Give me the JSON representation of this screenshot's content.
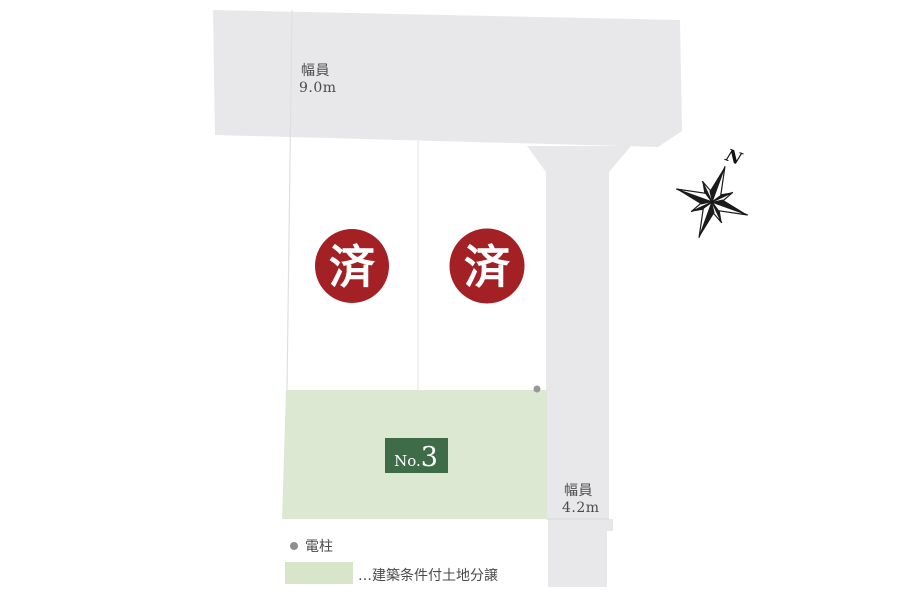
{
  "colors": {
    "road": "#e8e8ea",
    "road_divider_line": "#d9d9db",
    "boundary_line": "#dfdfe1",
    "plot_border": "#e6e6e6",
    "sold_badge": "#a32025",
    "sold_text": "#ffffff",
    "green_plot": "#dde8d2",
    "plot_badge_bg": "#3e6c49",
    "plot_badge_text": "#ffffff",
    "legend_swatch": "#d8e5c9",
    "label_text": "#4b4b4b",
    "compass": "#1a1a1a",
    "pole_dot_legend": "#8e8e90",
    "pole_dot_plan": "#98989a"
  },
  "top_road": {
    "width_label": "幅員",
    "width_value": "9.0m"
  },
  "side_road": {
    "width_label": "幅員",
    "width_value": "4.2m"
  },
  "plots": {
    "sold": [
      {
        "status_label": "済"
      },
      {
        "status_label": "済"
      }
    ],
    "available": {
      "prefix": "No.",
      "number": "3"
    }
  },
  "compass": {
    "north_label": "N"
  },
  "legend": {
    "pole_label": "電柱",
    "swatch_label": "…建築条件付土地分譲"
  }
}
